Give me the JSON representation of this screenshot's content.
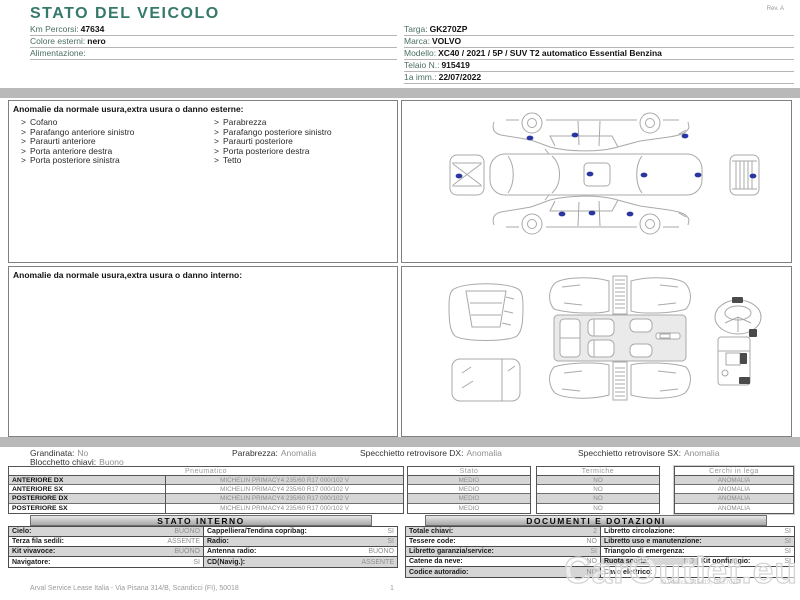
{
  "page": {
    "title": "STATO DEL VEICOLO",
    "revision": "Rev. A",
    "footer_text": "Arval Service Lease Italia  -  Via Pisana 314/B, Scandicci (FI), 50018",
    "footer_page": "1",
    "watermark": "CarOutlet.eu",
    "watermark_id": "ID verifica: 915419, GK270ZP"
  },
  "colors": {
    "accent_teal": "#35796a",
    "band_gray": "#b9b9b9",
    "row_gray": "#d6d6d6",
    "damage_dot_blue": "#2a36a0"
  },
  "vehicle": {
    "left_fields": [
      {
        "label": "Km Percorsi:",
        "value": "47634"
      },
      {
        "label": "Colore esterni:",
        "value": "nero"
      },
      {
        "label": "Alimentazione:",
        "value": ""
      }
    ],
    "right_fields": [
      {
        "label": "Targa:",
        "value": "GK270ZP"
      },
      {
        "label": "Marca:",
        "value": "VOLVO"
      },
      {
        "label": "Modello:",
        "value": "XC40 / 2021 / 5P / SUV T2 automatico Essential Benzina"
      },
      {
        "label": "Telaio N.:",
        "value": "915419"
      },
      {
        "label": "1a imm.:",
        "value": "22/07/2022"
      }
    ]
  },
  "exterior_anomalies": {
    "header": "Anomalie da normale usura,extra usura o danno esterne:",
    "bullet": ">",
    "col1": [
      "Cofano",
      "Parafango anteriore sinistro",
      "Paraurti anteriore",
      "Porta anteriore destra",
      "Porta posteriore sinistra"
    ],
    "col2": [
      "Parabrezza",
      "Parafango posteriore sinistro",
      "Paraurti posteriore",
      "Porta posteriore destra",
      "Tetto"
    ]
  },
  "interior_anomalies": {
    "header": "Anomalie da normale usura,extra usura o danno interno:"
  },
  "condition_summary": [
    {
      "label": "Grandinata:",
      "value": "No"
    },
    {
      "label": "Parabrezza:",
      "value": "Anomalia"
    },
    {
      "label": "Specchietto retrovisore DX:",
      "value": "Anomalia"
    },
    {
      "label": "Specchietto retrovisore SX:",
      "value": "Anomalia"
    },
    {
      "label": "Blocchetto chiavi:",
      "value": "Buono"
    }
  ],
  "tires": {
    "col_pneumatico": "Pneumatico",
    "col_stato": "Stato",
    "col_termiche": "Termiche",
    "col_cerchi": "Cerchi in lega",
    "rows": [
      {
        "position": "ANTERIORE DX",
        "spec": "MICHELIN PRIMACY4  235/60 R17 000/102 V",
        "stato": "MEDIO",
        "termiche": "NO",
        "cerchi": "ANOMALIA"
      },
      {
        "position": "ANTERIORE SX",
        "spec": "MICHELIN PRIMACY4  235/60 R17 000/102 V",
        "stato": "MEDIO",
        "termiche": "NO",
        "cerchi": "ANOMALIA"
      },
      {
        "position": "POSTERIORE DX",
        "spec": "MICHELIN PRIMACY4  235/60 R17 000/102 V",
        "stato": "MEDIO",
        "termiche": "NO",
        "cerchi": "ANOMALIA"
      },
      {
        "position": "POSTERIORE SX",
        "spec": "MICHELIN PRIMACY4  235/60 R17 000/102 V",
        "stato": "MEDIO",
        "termiche": "NO",
        "cerchi": "ANOMALIA"
      }
    ]
  },
  "stato_interno": {
    "title": "STATO INTERNO",
    "rows": [
      {
        "label_a": "Cielo:",
        "value_a": "BUONO",
        "label_b": "Cappelliera/Tendina copribag:",
        "value_b": "SI"
      },
      {
        "label_a": "Terza fila sedili:",
        "value_a": "ASSENTE",
        "label_b": "Radio:",
        "value_b": "SI"
      },
      {
        "label_a": "Kit vivavoce:",
        "value_a": "BUONO",
        "label_b": "Antenna radio:",
        "value_b": "BUONO"
      },
      {
        "label_a": "Navigatore:",
        "value_a": "SI",
        "label_b": "CD(Navig.):",
        "value_b": "ASSENTE"
      }
    ]
  },
  "documenti": {
    "title": "DOCUMENTI E DOTAZIONI",
    "rows": [
      {
        "label_a": "Totale chiavi:",
        "value_a": "2",
        "label_b": "Libretto circolazione:",
        "value_b": "SI"
      },
      {
        "label_a": "Tessere code:",
        "value_a": "NO",
        "label_b": "Libretto uso e manutenzione:",
        "value_b": "SI"
      },
      {
        "label_a": "Libretto garanzia/service:",
        "value_a": "SI",
        "label_b": "Triangolo di emergenza:",
        "value_b": "SI"
      },
      {
        "label_a": "Catene da neve:",
        "value_a": "NO",
        "label_b": "Ruota scorta:",
        "value_b": "NO",
        "label_c": "Kit gonfiaggio:",
        "value_c": "SI"
      },
      {
        "label_a": "Codice autoradio:",
        "value_a": "NO",
        "label_b": "Cavo elettrico:",
        "value_b": ""
      }
    ]
  }
}
